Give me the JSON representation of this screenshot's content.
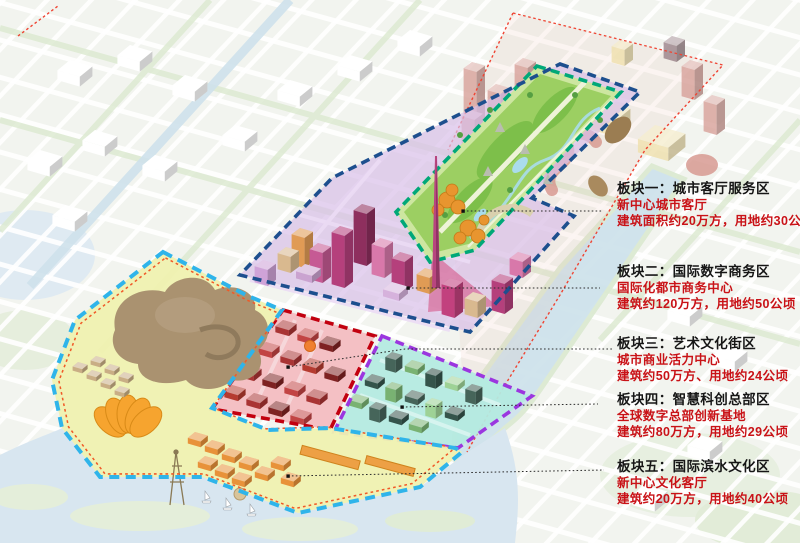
{
  "panels": [
    {
      "title": "板块一：城市客厅服务区",
      "subtitle": "新中心城市客厅",
      "metrics": "建筑面积约20万方，用地约30公顷"
    },
    {
      "title": "板块二：国际数字商务区",
      "subtitle": "国际化都市商务中心",
      "metrics": "建筑约120万方，用地约50公顷"
    },
    {
      "title": "板块三：艺术文化街区",
      "subtitle": "城市商业活力中心",
      "metrics": "建筑约50万方、用地约24公顷"
    },
    {
      "title": "板块四：智慧科创总部区",
      "subtitle": "全球数字总部创新基地",
      "metrics": "建筑约80万方，用地约29公顷"
    },
    {
      "title": "板块五：国际滨水文化区",
      "subtitle": "新中心文化客厅",
      "metrics": "建筑约20万方，用地约40公顷"
    }
  ],
  "colors": {
    "outline_core": "#1d4f8e",
    "outline_park": "#00a878",
    "outline_art": "#c2000f",
    "outline_tech": "#9b36df",
    "outline_waterfront": "#2fb4ea",
    "boundary_dotted": "#ef4433",
    "inner_dotted": "#f05a28",
    "leader": "#2b2b2b",
    "title_text": "#161616",
    "accent_text": "#c91217"
  }
}
